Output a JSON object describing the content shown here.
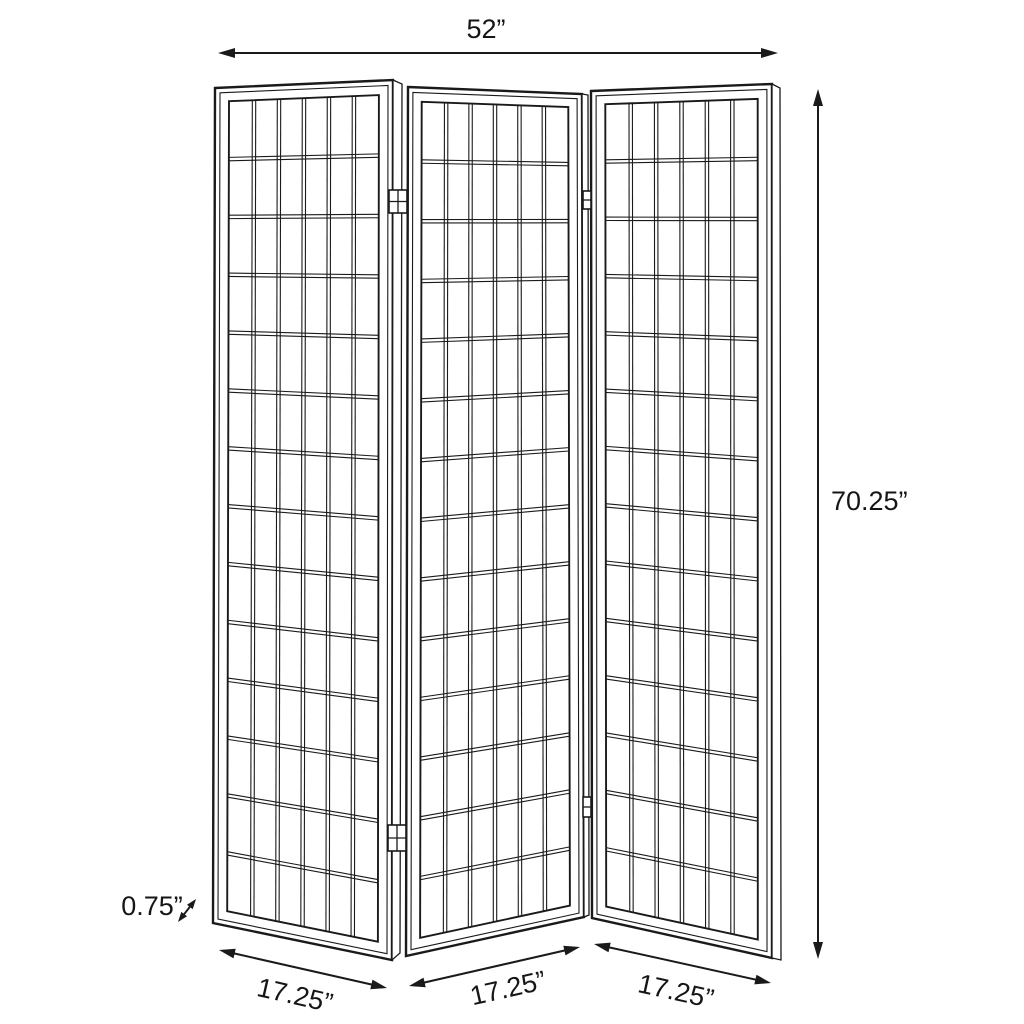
{
  "diagram_labels": {
    "overall_width": "52”",
    "overall_height": "70.25”",
    "panel_thickness": "0.75”",
    "panel_widths": [
      "17.25”",
      "17.25”",
      "17.25”"
    ]
  },
  "structure": {
    "panel_count": 3,
    "grid_columns": 6,
    "grid_rows": 14
  },
  "colors": {
    "line": "#1a1a1a",
    "background": "#ffffff"
  }
}
